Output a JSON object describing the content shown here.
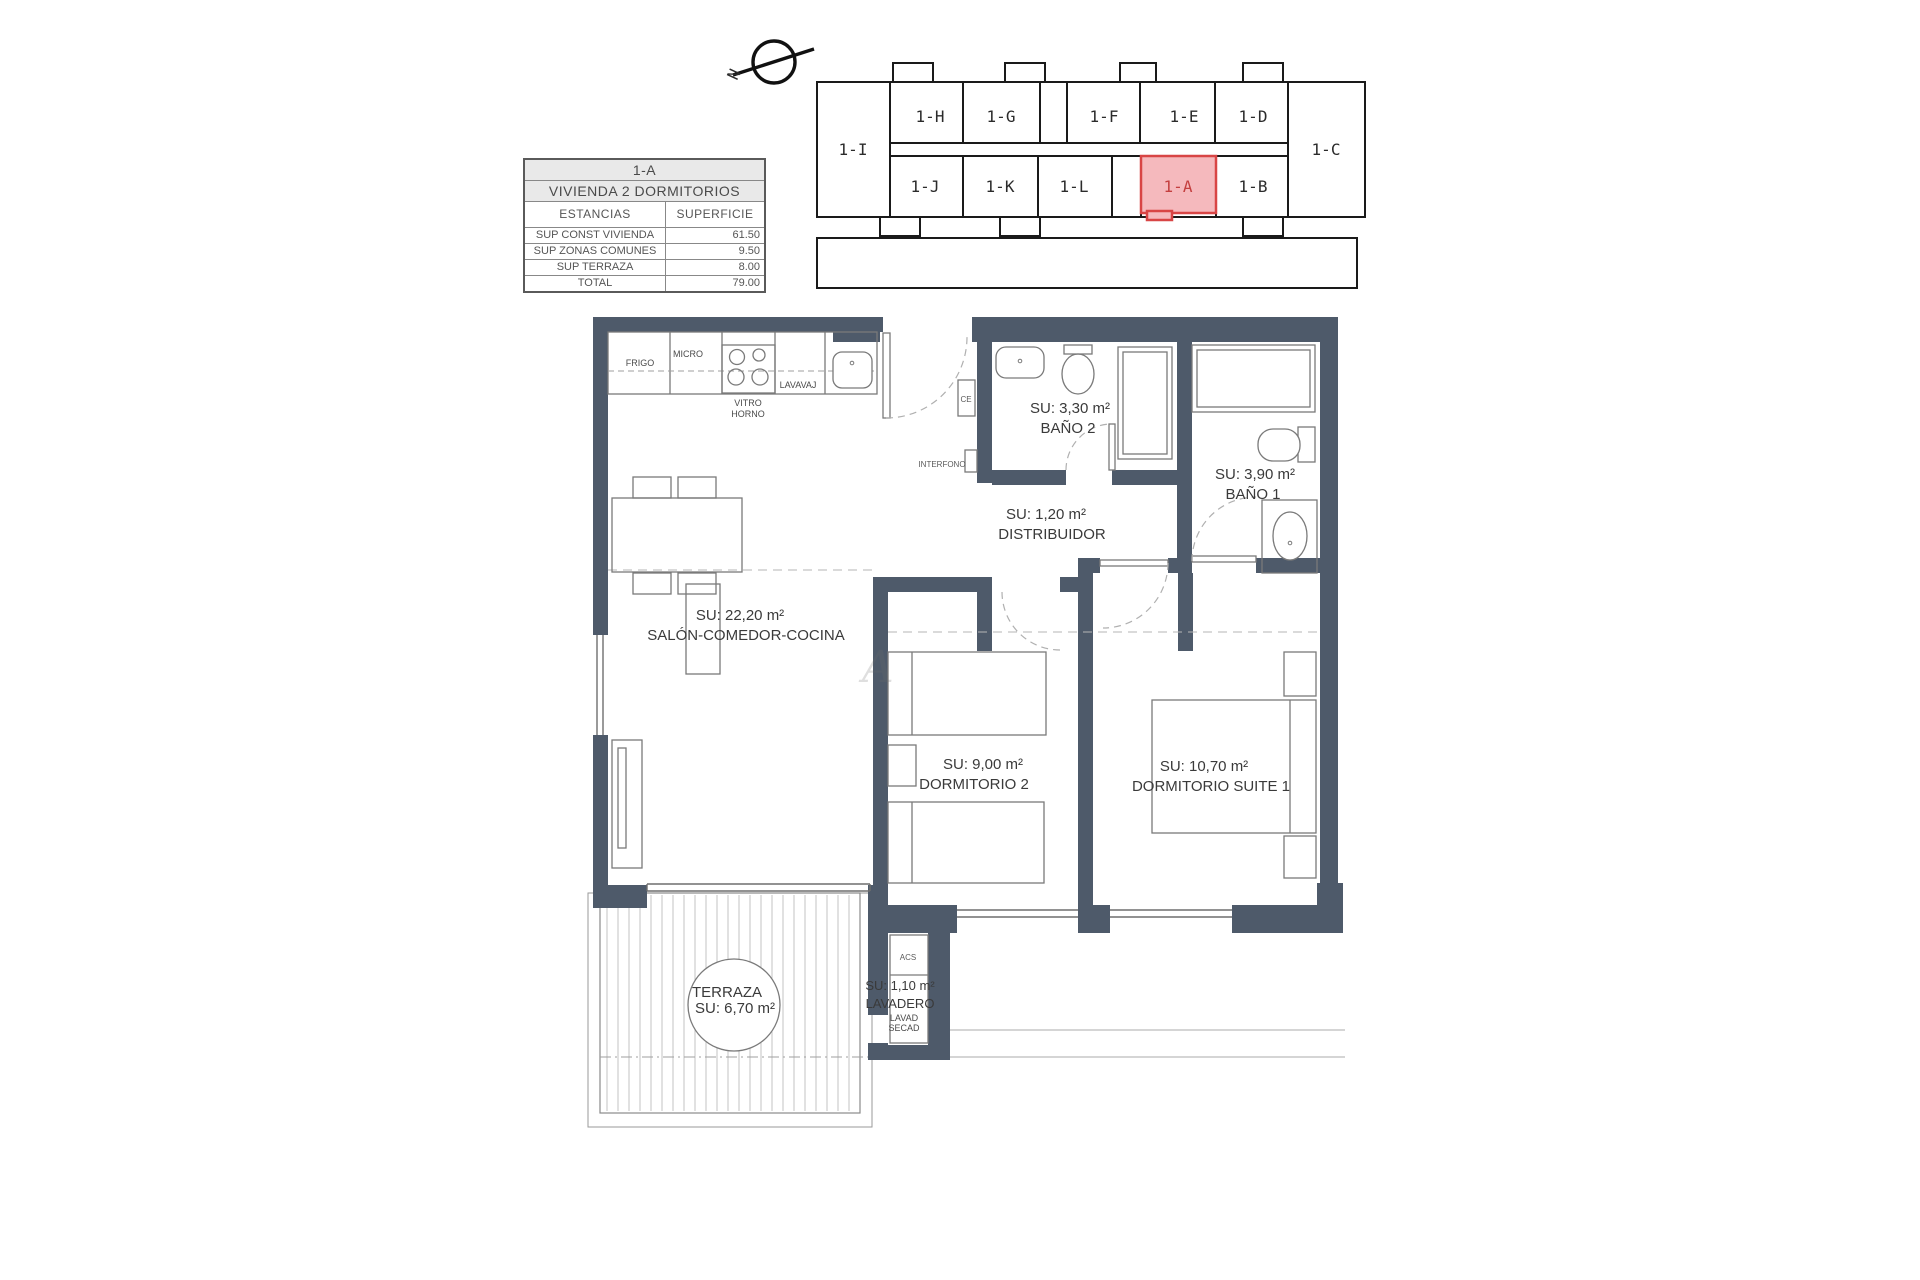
{
  "title": "Plano vivienda 1-A",
  "colors": {
    "wall": "#4e5a6a",
    "highlight_fill": "#f5b9bd",
    "highlight_border": "#d84545",
    "table_header_bg": "#e9e9e9",
    "outline": "#1a1a1a"
  },
  "north_arrow": {
    "label": "N"
  },
  "info_table": {
    "unit": "1-A",
    "type": "VIVIENDA 2 DORMITORIOS",
    "col_headers": {
      "estancias": "ESTANCIAS",
      "superficie": "SUPERFICIE"
    },
    "rows": [
      {
        "label": "SUP CONST VIVIENDA",
        "value": "61.50"
      },
      {
        "label": "SUP ZONAS COMUNES",
        "value": "9.50"
      },
      {
        "label": "SUP TERRAZA",
        "value": "8.00"
      },
      {
        "label": "TOTAL",
        "value": "79.00"
      }
    ]
  },
  "keyplan": {
    "highlighted_unit": "1-A",
    "units": {
      "i": "1-I",
      "h": "1-H",
      "g": "1-G",
      "f": "1-F",
      "e": "1-E",
      "d": "1-D",
      "c": "1-C",
      "j": "1-J",
      "k": "1-K",
      "l": "1-L",
      "a": "1-A",
      "b": "1-B"
    }
  },
  "rooms": {
    "salon": {
      "area": "SU: 22,20 m²",
      "name": "SALÓN-COMEDOR-COCINA"
    },
    "bano2": {
      "area": "SU: 3,30 m²",
      "name": "BAÑO 2"
    },
    "bano1": {
      "area": "SU: 3,90 m²",
      "name": "BAÑO 1"
    },
    "distribuidor": {
      "area": "SU: 1,20 m²",
      "name": "DISTRIBUIDOR"
    },
    "dormitorio2": {
      "area": "SU: 9,00 m²",
      "name": "DORMITORIO 2"
    },
    "suite": {
      "area": "SU: 10,70 m²",
      "name": "DORMITORIO SUITE 1"
    },
    "terraza": {
      "name": "TERRAZA",
      "area": "SU: 6,70 m²"
    },
    "lavadero": {
      "area": "SU: 1,10 m²",
      "name": "LAVADERO",
      "acs": "ACS",
      "sub1": "LAVAD",
      "sub2": "SECAD"
    }
  },
  "kitchen": {
    "frigo": "FRIGO",
    "micro": "MICRO",
    "vitro": "VITRO",
    "horno": "HORNO",
    "lavavaj": "LAVAVAJ"
  },
  "fixtures": {
    "ce": "CE",
    "interfono": "INTERFONO"
  },
  "watermark": "A"
}
